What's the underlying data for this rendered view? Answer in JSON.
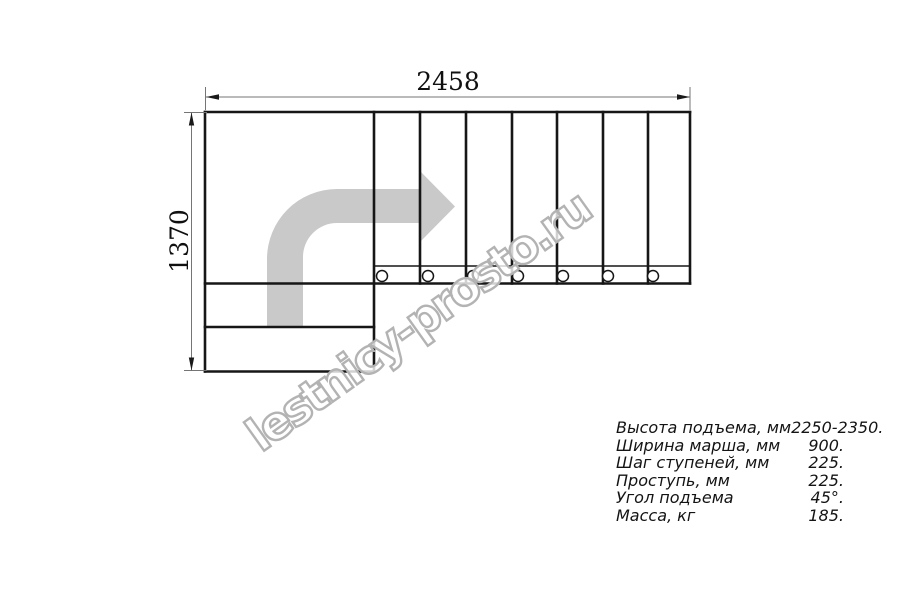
{
  "watermark": {
    "text": "lestnicy-prosto.ru"
  },
  "dimensions": {
    "width_label": "2458",
    "height_label": "1370"
  },
  "specs": {
    "rows": [
      {
        "label": "Высота подъема, мм",
        "value": "2250-2350."
      },
      {
        "label": "Ширина марша, мм",
        "value": "900."
      },
      {
        "label": "Шаг ступеней, мм",
        "value": "225."
      },
      {
        "label": "Проступь, мм",
        "value": "225."
      },
      {
        "label": "Угол подъема",
        "value": "45°."
      },
      {
        "label": "Масса, кг",
        "value": "185."
      }
    ]
  },
  "plan": {
    "tread_count": 7,
    "outline": {
      "left": 205,
      "top": 112,
      "right": 690,
      "mid_bottom": 283.5,
      "landing_right": 374,
      "step_y1": 327,
      "step_y2": 371.5,
      "band_top": 266
    },
    "tread_dividers_x": [
      420,
      466,
      512,
      557,
      603,
      648
    ],
    "fasteners": {
      "cx": [
        382,
        428,
        473,
        518,
        563,
        608,
        653
      ],
      "cy": 276,
      "r": 5.5
    },
    "arrow_path": "M267,327.5 L267,259 A70 70 0 0 1 337,189 L420,189 L420,171 L455,206.5 L420,242 L420,223 L337,223 A34 34 0 0 0 303,257 L303,327.5 Z"
  },
  "colors": {
    "line": "#161616",
    "dim_line": "#757575",
    "arrow_fill": "#c9c9c9",
    "watermark_stroke": "#b3b3b3",
    "text": "#141414"
  }
}
